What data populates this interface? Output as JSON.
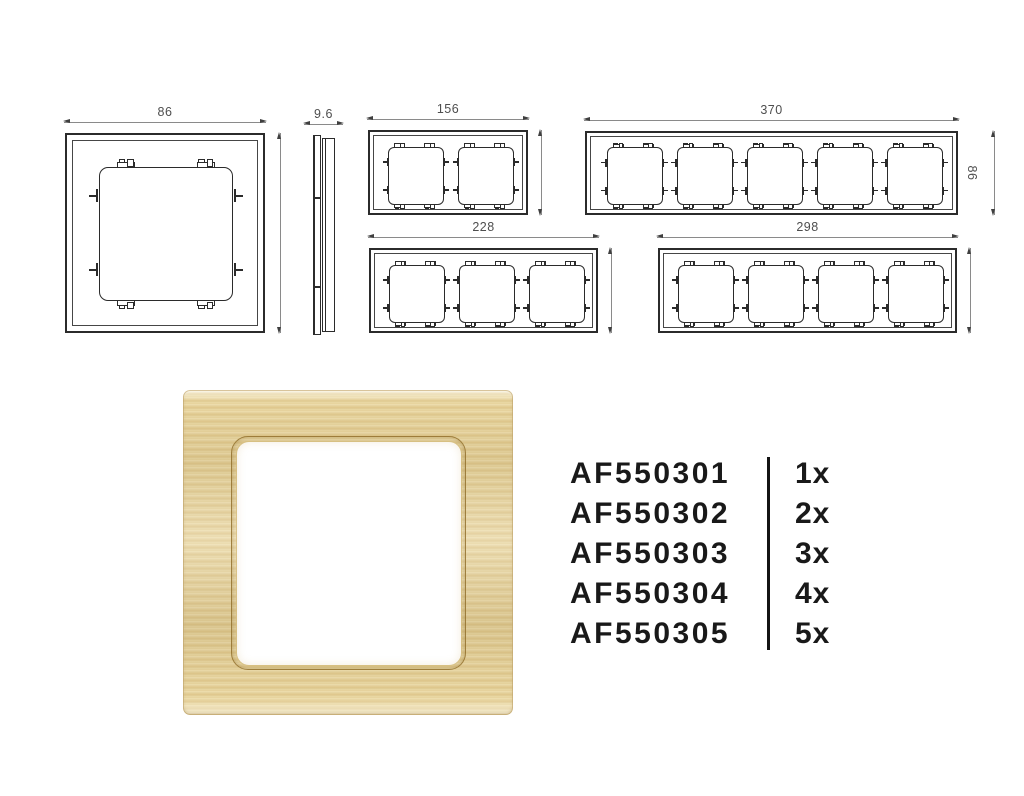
{
  "colors": {
    "line": "#2b2b2b",
    "dimension_line": "#8a8a8a",
    "dimension_text": "#4e4e4e",
    "list_text": "#191919",
    "gold_light": "#f3e6bd",
    "gold_mid": "#e4cf97",
    "gold_dark": "#cfae6e"
  },
  "drawings": {
    "single_front": {
      "gangs": 1,
      "width_label": "86",
      "height_label": "86"
    },
    "side_profile": {
      "depth_label": "9.6"
    },
    "gang2": {
      "gangs": 2,
      "width_label": "156",
      "height_label": "86"
    },
    "gang5": {
      "gangs": 5,
      "width_label": "370",
      "height_label": "86"
    },
    "gang3": {
      "gangs": 3,
      "width_label": "228",
      "height_label": "85"
    },
    "gang4": {
      "gangs": 4,
      "width_label": "298",
      "height_label": "85"
    }
  },
  "parts_list": [
    {
      "code": "AF550301",
      "qty": "1x"
    },
    {
      "code": "AF550302",
      "qty": "2x"
    },
    {
      "code": "AF550303",
      "qty": "3x"
    },
    {
      "code": "AF550304",
      "qty": "4x"
    },
    {
      "code": "AF550305",
      "qty": "5x"
    }
  ]
}
